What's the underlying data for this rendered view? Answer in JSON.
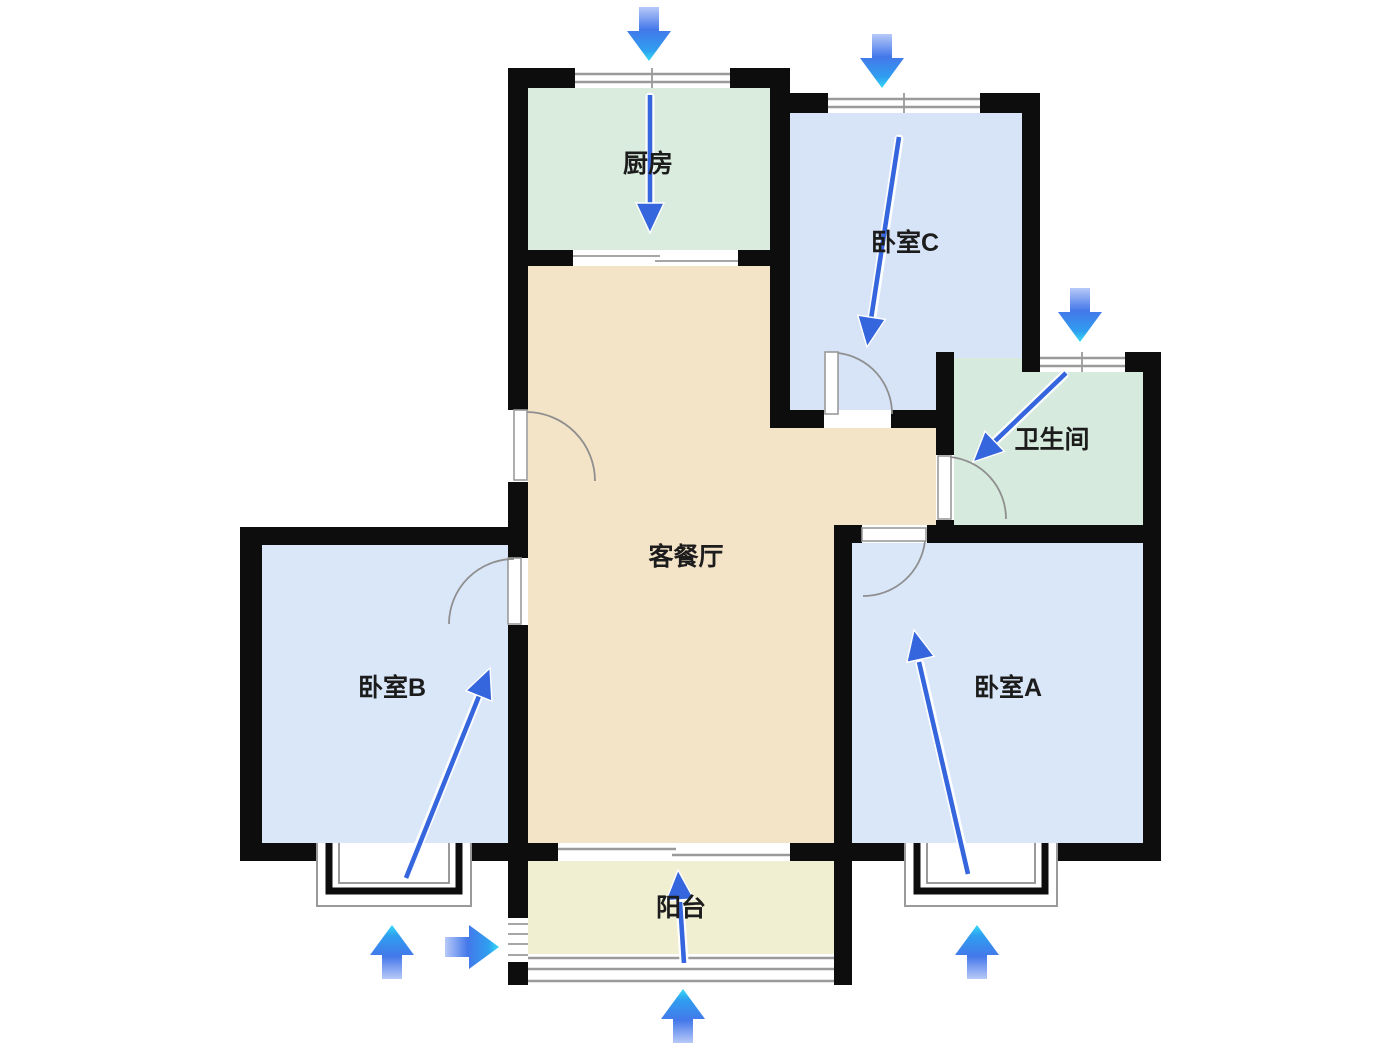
{
  "page": {
    "background": "#ffffff",
    "type": "apartment-floor-plan"
  },
  "colors": {
    "wall": "#0d0d0d",
    "door_arc": "#8f8f8f",
    "window_line": "#9a9a9a",
    "arrow_tail": "#b7c9f8",
    "arrow_mid": "#4478ea",
    "arrow_tip": "#33dbf6",
    "arrow_solid": "#3566dd"
  },
  "rooms": {
    "kitchen": {
      "label": "厨房",
      "color": "#d9ecdd"
    },
    "bedroom_c": {
      "label": "卧室C",
      "color": "#d7e4f8"
    },
    "bathroom": {
      "label": "卫生间",
      "color": "#d6ebde"
    },
    "living": {
      "label": "客餐厅",
      "color": "#f4e4c7"
    },
    "bedroom_b": {
      "label": "卧室B",
      "color": "#dae7f9"
    },
    "bedroom_a": {
      "label": "卧室A",
      "color": "#dae7f9"
    },
    "balcony": {
      "label": "阳台",
      "color": "#f0efd2"
    }
  },
  "airflow": {
    "exterior_arrows": [
      "down-into-kitchen-window",
      "down-into-bedroom-c-window",
      "down-into-bathroom-window",
      "up-into-bedroom-b-bay-window",
      "right-into-balcony-side-window",
      "up-into-balcony-window",
      "up-into-bedroom-a-bay-window"
    ],
    "interior_arrows": [
      "kitchen-down",
      "bedroom-c-down",
      "bathroom-diagonal-down-left",
      "bedroom-b-up-right",
      "bedroom-a-up",
      "balcony-up"
    ]
  }
}
